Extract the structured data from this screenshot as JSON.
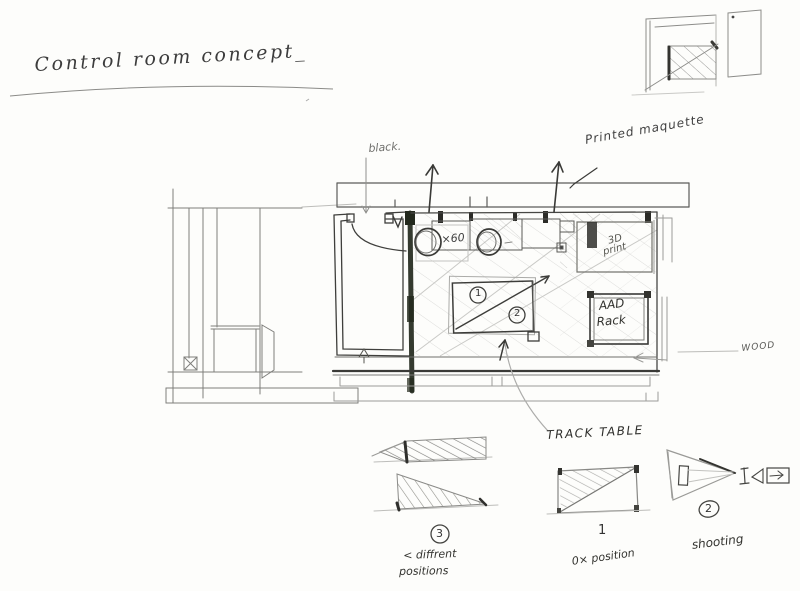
{
  "title": "Control room concept_",
  "annotations": {
    "black": "black.",
    "printed_maquette": "Printed maquette",
    "wood": "WOOD",
    "track_table": "TRACK TABLE",
    "x60": "×60",
    "print_3d_line1": "3D",
    "print_3d_line2": "print",
    "rack_line1": "AAD",
    "rack_line2": "Rack"
  },
  "plan_markers": {
    "pos1": "1",
    "pos2": "2"
  },
  "figures": {
    "left": {
      "number": "3",
      "caption_line1": "< diffrent",
      "caption_line2": "positions"
    },
    "middle": {
      "number": "1",
      "caption": "0× position"
    },
    "right": {
      "number": "2",
      "caption": "shooting"
    }
  },
  "colors": {
    "paper": "#fdfdfb",
    "pencil": "#9a9a9a",
    "pen": "#3a3a3a",
    "ink_dark": "#23291d"
  }
}
